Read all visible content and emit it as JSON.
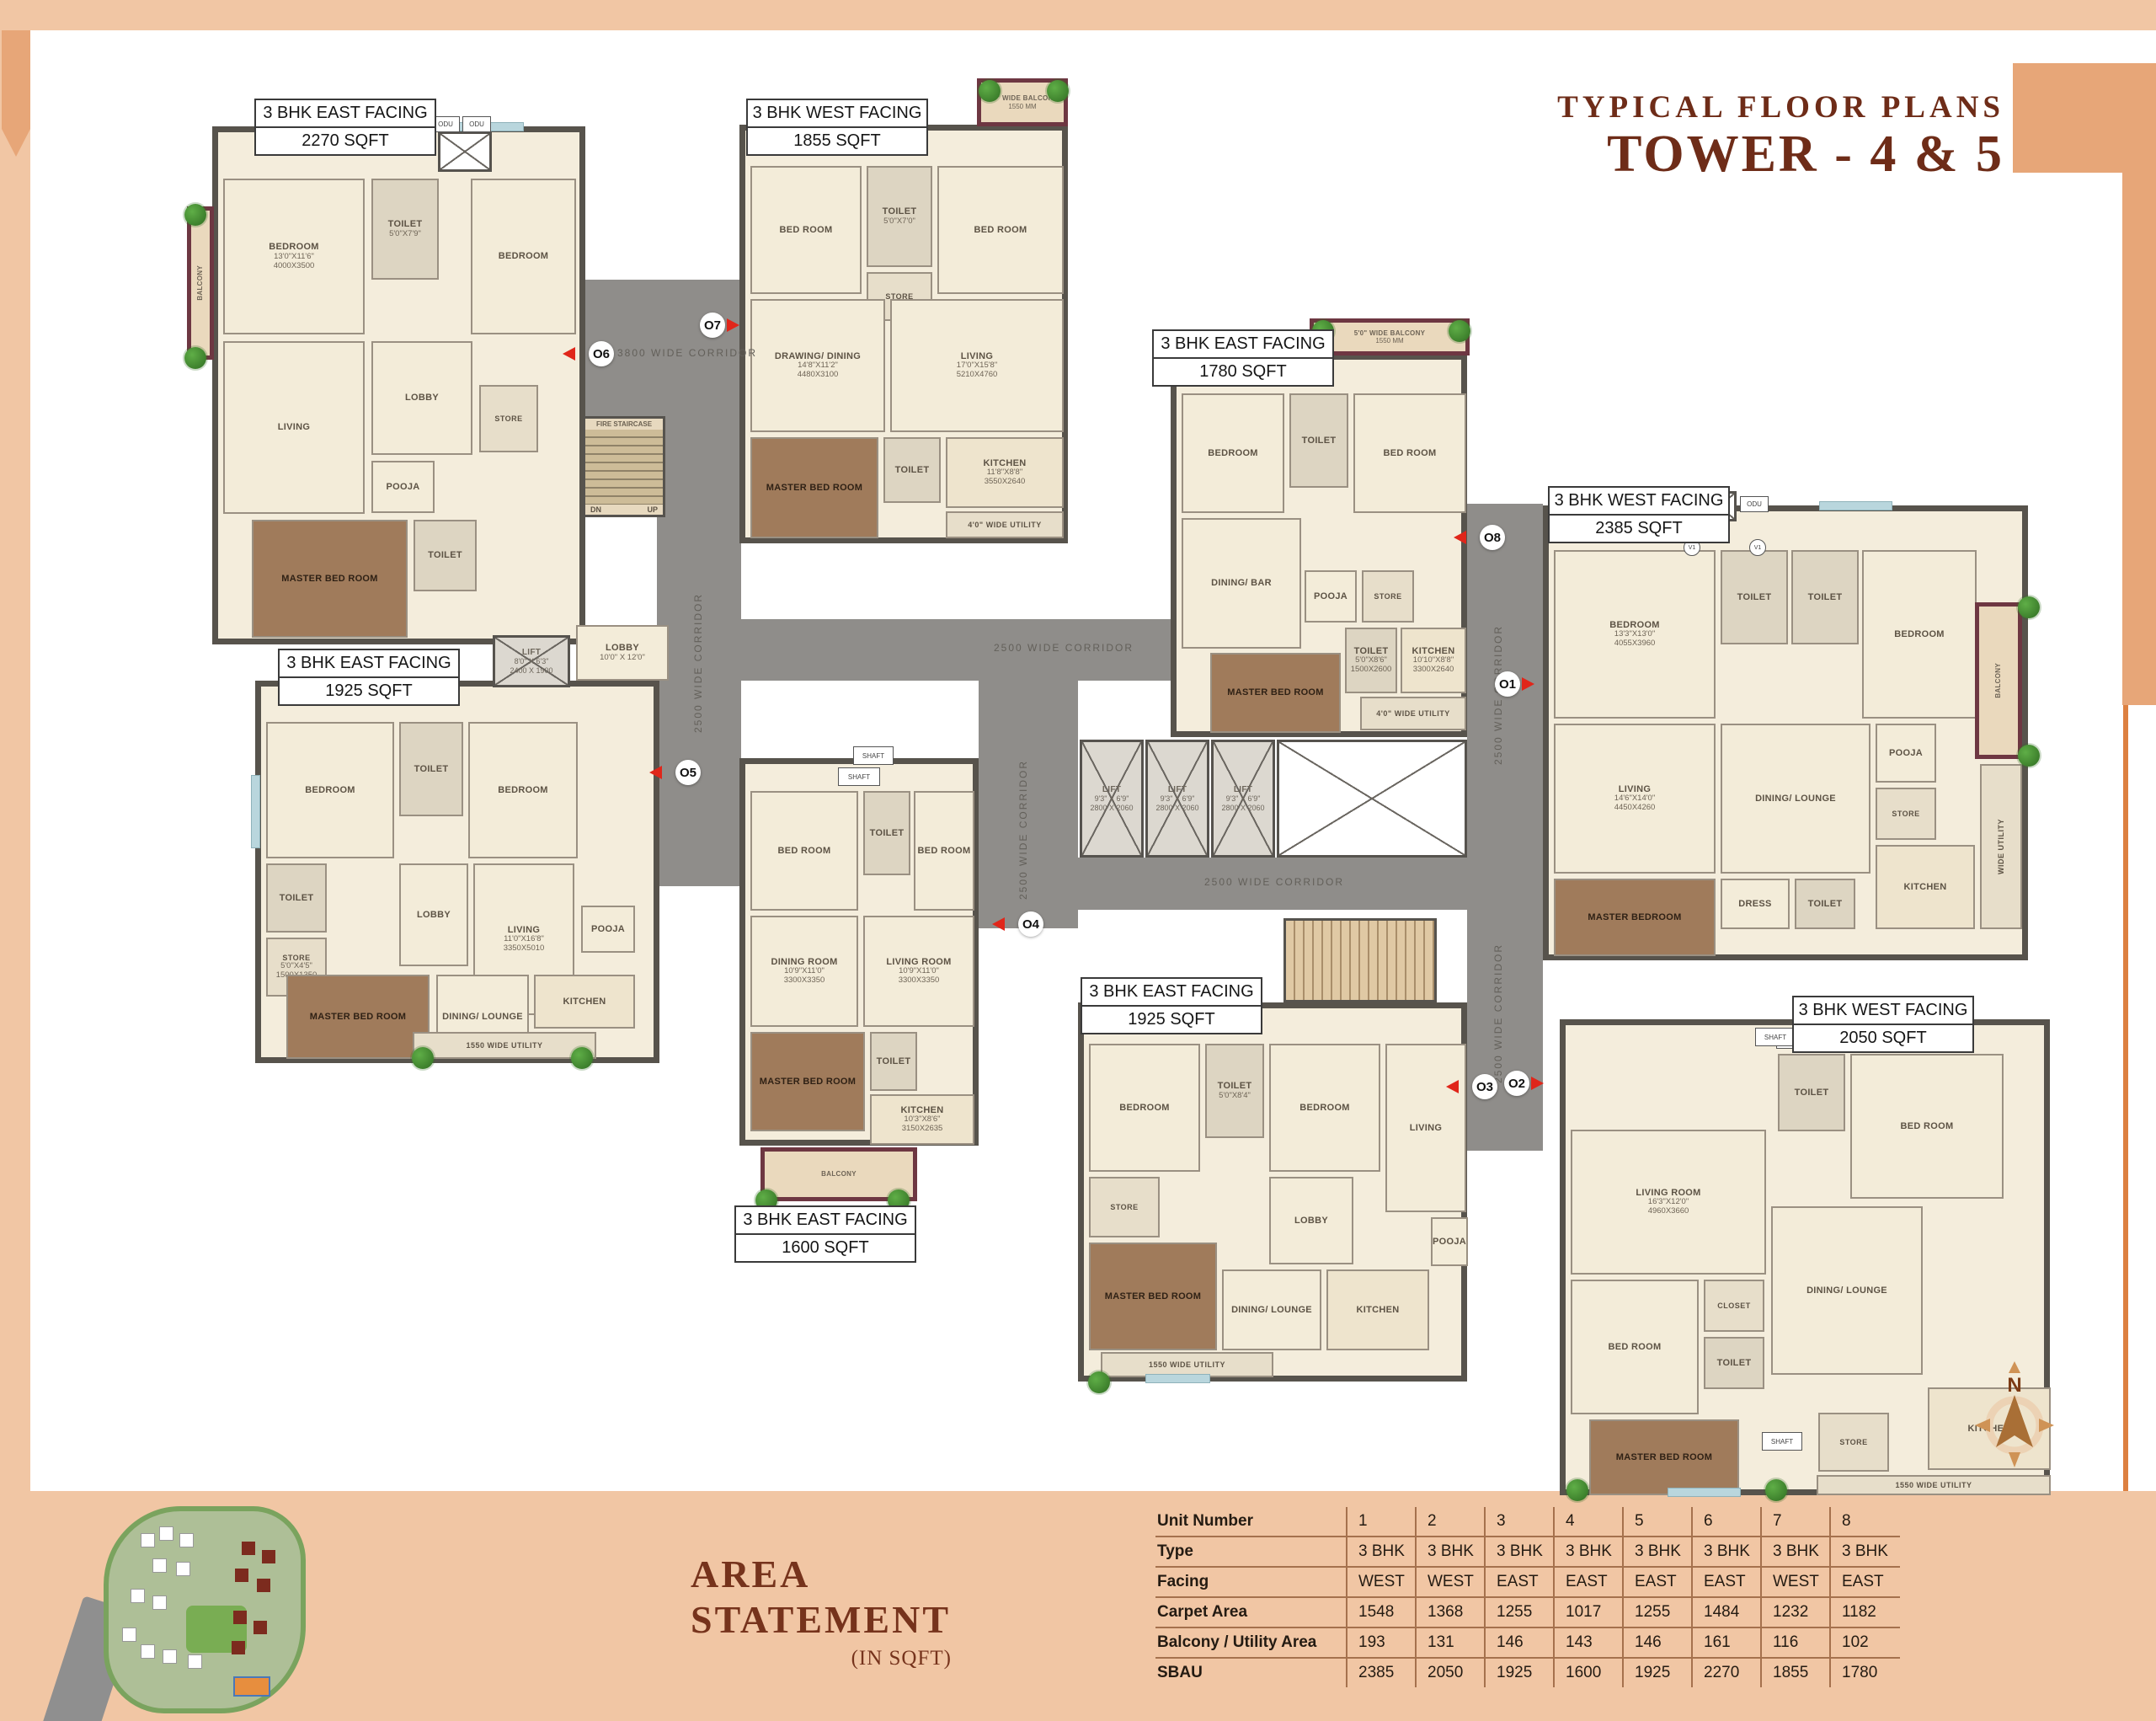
{
  "header": {
    "title_small": "TYPICAL FLOOR PLANS",
    "title_large": "TOWER - 4 & 5"
  },
  "compass": {
    "label": "N"
  },
  "core": {
    "fire_staircase": "FIRE STAIRCASE",
    "dn": "DN",
    "up": "UP",
    "lift": "LIFT",
    "lift_dims": "9'3\" X 6'9\"",
    "lift_mm": "2800 X 2060",
    "lift2_dims": "8'0\" X 6'3\"",
    "lift2_mm": "2400 X 1900",
    "lobby": "LOBBY",
    "lobby_dims": "10'0\" X 12'0\"",
    "shaft": "SHAFT",
    "odu": "ODU",
    "v1": "V1",
    "corridor_3800": "3800 WIDE CORRIDOR",
    "corridor_2500": "2500 WIDE CORRIDOR"
  },
  "units": [
    {
      "number": "1",
      "marker": "O1",
      "facing": "3 BHK WEST FACING",
      "area": "2385 SQFT",
      "rooms": [
        {
          "name": "BEDROOM",
          "dims": "13'3\"X13'0\"",
          "mm": "4055X3960"
        },
        {
          "name": "TOILET"
        },
        {
          "name": "TOILET"
        },
        {
          "name": "BEDROOM"
        },
        {
          "name": "LIVING",
          "dims": "14'6\"X14'0\"",
          "mm": "4450X4260"
        },
        {
          "name": "DINING/ LOUNGE"
        },
        {
          "name": "POOJA"
        },
        {
          "name": "STORE"
        },
        {
          "name": "DRESS"
        },
        {
          "name": "MASTER BEDROOM"
        },
        {
          "name": "TOILET"
        },
        {
          "name": "KITCHEN"
        },
        {
          "name": "WIDE UTILITY"
        },
        {
          "name": "BALCONY"
        }
      ]
    },
    {
      "number": "2",
      "marker": "O2",
      "facing": "3 BHK WEST FACING",
      "area": "2050 SQFT",
      "rooms": [
        {
          "name": "SHAFT"
        },
        {
          "name": "TOILET"
        },
        {
          "name": "BED ROOM"
        },
        {
          "name": "LIVING ROOM",
          "dims": "16'3\"X12'0\"",
          "mm": "4960X3660"
        },
        {
          "name": "BED ROOM"
        },
        {
          "name": "DINING/ LOUNGE"
        },
        {
          "name": "CLOSET"
        },
        {
          "name": "TOILET"
        },
        {
          "name": "MASTER BED ROOM"
        },
        {
          "name": "KITCHEN"
        },
        {
          "name": "STORE"
        },
        {
          "name": "1550 WIDE UTILITY"
        }
      ]
    },
    {
      "number": "3",
      "marker": "O3",
      "facing": "3 BHK EAST FACING",
      "area": "1925 SQFT",
      "rooms": [
        {
          "name": "BEDROOM"
        },
        {
          "name": "TOILET",
          "dims": "5'0\"X8'4\""
        },
        {
          "name": "BEDROOM"
        },
        {
          "name": "LIVING"
        },
        {
          "name": "LOBBY"
        },
        {
          "name": "STORE"
        },
        {
          "name": "MASTER BED ROOM"
        },
        {
          "name": "DINING/ LOUNGE"
        },
        {
          "name": "KITCHEN"
        },
        {
          "name": "POOJA"
        },
        {
          "name": "1550 WIDE UTILITY"
        }
      ]
    },
    {
      "number": "4",
      "marker": "O4",
      "facing": "3 BHK EAST FACING",
      "area": "1600 SQFT",
      "rooms": [
        {
          "name": "SHAFT"
        },
        {
          "name": "BED ROOM"
        },
        {
          "name": "TOILET"
        },
        {
          "name": "BED ROOM"
        },
        {
          "name": "DINING ROOM",
          "dims": "10'9\"X11'0\"",
          "mm": "3300X3350"
        },
        {
          "name": "LIVING ROOM",
          "dims": "10'9\"X11'0\"",
          "mm": "3300X3350"
        },
        {
          "name": "MASTER BED ROOM"
        },
        {
          "name": "TOILET"
        },
        {
          "name": "KITCHEN",
          "dims": "10'3\"X8'6\"",
          "mm": "3150X2635"
        },
        {
          "name": "BALCONY"
        }
      ]
    },
    {
      "number": "5",
      "marker": "O5",
      "facing": "3 BHK EAST FACING",
      "area": "1925 SQFT",
      "rooms": [
        {
          "name": "BEDROOM"
        },
        {
          "name": "TOILET"
        },
        {
          "name": "BEDROOM"
        },
        {
          "name": "LIVING",
          "dims": "11'0\"X16'8\"",
          "mm": "3350X5010"
        },
        {
          "name": "LOBBY"
        },
        {
          "name": "TOILET"
        },
        {
          "name": "STORE",
          "dims": "5'0\"X4'5\"",
          "mm": "1500X1350"
        },
        {
          "name": "MASTER BED ROOM"
        },
        {
          "name": "DINING/ LOUNGE"
        },
        {
          "name": "KITCHEN"
        },
        {
          "name": "POOJA"
        },
        {
          "name": "1550 WIDE UTILITY"
        }
      ]
    },
    {
      "number": "6",
      "marker": "O6",
      "facing": "3 BHK EAST FACING",
      "area": "2270 SQFT",
      "rooms": [
        {
          "name": "BEDROOM",
          "dims": "13'0\"X11'6\"",
          "mm": "4000X3500"
        },
        {
          "name": "TOILET",
          "dims": "5'0\"X7'9\""
        },
        {
          "name": "BEDROOM"
        },
        {
          "name": "LIVING"
        },
        {
          "name": "LOBBY"
        },
        {
          "name": "STORE"
        },
        {
          "name": "POOJA"
        },
        {
          "name": "MASTER BED ROOM"
        },
        {
          "name": "TOILET"
        },
        {
          "name": "BALCONY"
        }
      ]
    },
    {
      "number": "7",
      "marker": "O7",
      "facing": "3 BHK WEST FACING",
      "area": "1855 SQFT",
      "rooms": [
        {
          "name": "BED ROOM"
        },
        {
          "name": "TOILET",
          "dims": "5'0\"X7'0\""
        },
        {
          "name": "BED ROOM"
        },
        {
          "name": "STORE"
        },
        {
          "name": "DRAWING/ DINING",
          "dims": "14'8\"X11'2\"",
          "mm": "4480X3100"
        },
        {
          "name": "LIVING",
          "dims": "17'0\"X15'8\"",
          "mm": "5210X4760"
        },
        {
          "name": "MASTER BED ROOM"
        },
        {
          "name": "TOILET"
        },
        {
          "name": "KITCHEN",
          "dims": "11'8\"X8'8\"",
          "mm": "3550X2640"
        },
        {
          "name": "4'0\" WIDE UTILITY",
          "mm": "1200MM"
        },
        {
          "name": "5'0\" WIDE BALCONY",
          "mm": "1550 MM"
        }
      ]
    },
    {
      "number": "8",
      "marker": "O8",
      "facing": "3 BHK EAST FACING",
      "area": "1780 SQFT",
      "rooms": [
        {
          "name": "BEDROOM"
        },
        {
          "name": "TOILET"
        },
        {
          "name": "BED ROOM"
        },
        {
          "name": "DINING/ BAR"
        },
        {
          "name": "POOJA"
        },
        {
          "name": "STORE"
        },
        {
          "name": "MASTER BED ROOM"
        },
        {
          "name": "TOILET",
          "dims": "5'0\"X8'6\"",
          "mm": "1500X2600"
        },
        {
          "name": "KITCHEN",
          "dims": "10'10\"X8'8\"",
          "mm": "3300X2640"
        },
        {
          "name": "4'0\" WIDE UTILITY",
          "mm": "1200MM"
        },
        {
          "name": "5'0\" WIDE BALCONY",
          "mm": "1550 MM"
        }
      ]
    }
  ],
  "area_statement": {
    "title_line1": "AREA",
    "title_line2": "STATEMENT",
    "subtitle": "(IN SQFT)",
    "rows": [
      {
        "label": "Unit Number",
        "values": [
          "1",
          "2",
          "3",
          "4",
          "5",
          "6",
          "7",
          "8"
        ]
      },
      {
        "label": "Type",
        "values": [
          "3 BHK",
          "3 BHK",
          "3 BHK",
          "3 BHK",
          "3 BHK",
          "3 BHK",
          "3 BHK",
          "3 BHK"
        ]
      },
      {
        "label": "Facing",
        "values": [
          "WEST",
          "WEST",
          "EAST",
          "EAST",
          "EAST",
          "EAST",
          "WEST",
          "EAST"
        ]
      },
      {
        "label": "Carpet Area",
        "values": [
          "1548",
          "1368",
          "1255",
          "1017",
          "1255",
          "1484",
          "1232",
          "1182"
        ]
      },
      {
        "label": "Balcony / Utility Area",
        "values": [
          "193",
          "131",
          "146",
          "143",
          "146",
          "161",
          "116",
          "102"
        ]
      },
      {
        "label": "SBAU",
        "values": [
          "2385",
          "2050",
          "1925",
          "1600",
          "1925",
          "2270",
          "1855",
          "1780"
        ]
      }
    ]
  }
}
